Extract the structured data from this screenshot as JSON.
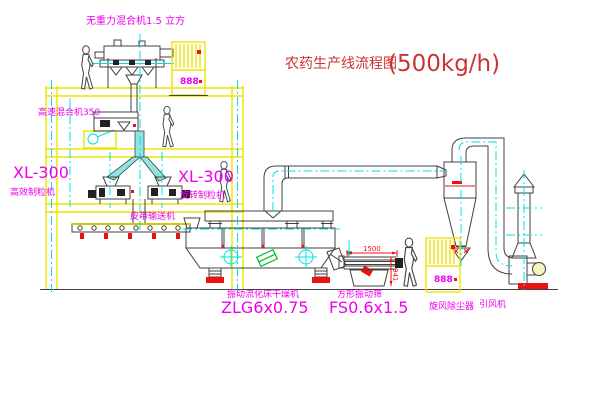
{
  "title": {
    "name": "农药生产线流程图",
    "capacity": "(500kg/h)"
  },
  "equipment": {
    "gravity_mixer": {
      "label": "无重力混合机1.5 立方"
    },
    "high_speed_mixer": {
      "label": "高速混合机350"
    },
    "granulator_left": {
      "model": "XL-300",
      "name": "高效制粒机"
    },
    "granulator_right": {
      "model": "XL-300",
      "name": "旋转制粒机"
    },
    "belt_conveyor": {
      "label": "皮带输送机"
    },
    "fluid_bed_dryer": {
      "name": "振动流化床干燥机",
      "model": "ZLG6x0.75"
    },
    "vibrating_screen": {
      "name": "方形振动筛",
      "model": "FS0.6x1.5",
      "dim_width": "1500",
      "dim_height": "941"
    },
    "cyclone": {
      "label": "旋风除尘器"
    },
    "fan": {
      "label": "引风机"
    },
    "control_cabinet_top": {
      "display": "888"
    },
    "control_cabinet_right": {
      "display": "888"
    }
  },
  "colors": {
    "background": "#ffffff",
    "frame_yellow": "#f0e400",
    "centerline_cyan": "#00e0e0",
    "label_magenta": "#ee00ee",
    "title_red": "#cc3333",
    "accent_red": "#ee1111",
    "logo_green": "#00bb33",
    "line_gray": "#404040"
  }
}
